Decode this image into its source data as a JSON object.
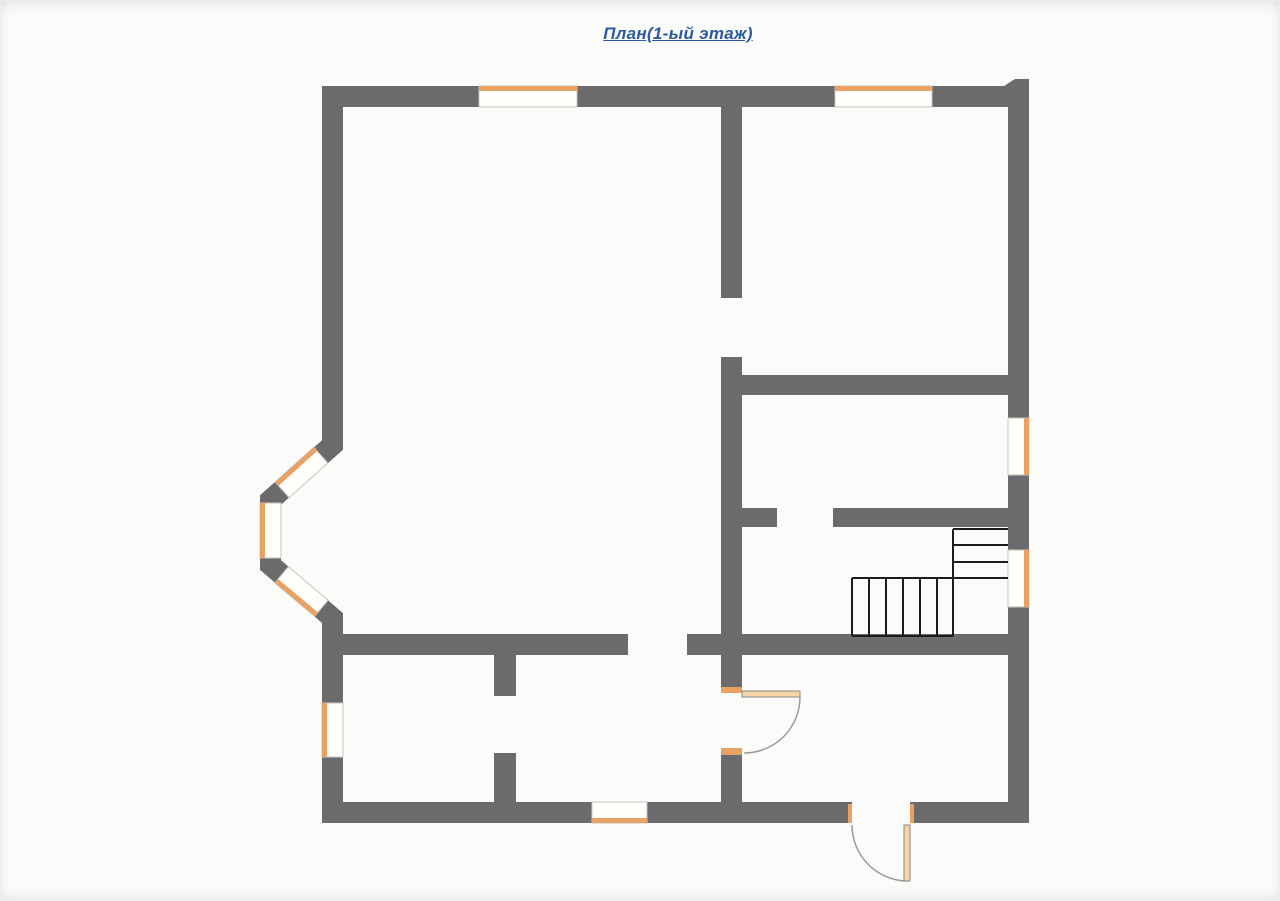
{
  "title": {
    "text": "План(1-ый этаж)"
  },
  "colors": {
    "background": "#fbfbf9",
    "wall": "#6b6a6d",
    "window_fill": "#fffefa",
    "window_frame": "#c6c5c0",
    "window_accent": "#e9a263",
    "stair_line": "#1c1c1c",
    "door_arc": "#9b9b9b",
    "door_leaf_fill": "#f6d4a4",
    "door_leaf_edge": "#8a8a8a",
    "title_color": "#2b5a9e"
  },
  "floorplan": {
    "canvas": {
      "width": 1280,
      "height": 901
    },
    "wall_rects": [
      {
        "name": "outer-wall-top-left",
        "x": 322,
        "y": 86,
        "w": 157,
        "h": 21
      },
      {
        "name": "outer-wall-top-mid",
        "x": 577,
        "y": 86,
        "w": 258,
        "h": 21
      },
      {
        "name": "outer-wall-top-right",
        "x": 932,
        "y": 86,
        "w": 72,
        "h": 21
      },
      {
        "name": "outer-wall-right-upper",
        "x": 1008,
        "y": 107,
        "w": 21,
        "h": 311
      },
      {
        "name": "outer-wall-right-mid",
        "x": 1008,
        "y": 475,
        "w": 21,
        "h": 75
      },
      {
        "name": "outer-wall-right-lower",
        "x": 1008,
        "y": 607,
        "w": 21,
        "h": 216
      },
      {
        "name": "outer-wall-bottom-left",
        "x": 322,
        "y": 802,
        "w": 270,
        "h": 21
      },
      {
        "name": "outer-wall-bottom-mid",
        "x": 647,
        "y": 802,
        "w": 205,
        "h": 21
      },
      {
        "name": "outer-wall-bottom-right",
        "x": 910,
        "y": 802,
        "w": 119,
        "h": 21
      },
      {
        "name": "outer-wall-left-upper",
        "x": 322,
        "y": 86,
        "w": 21,
        "h": 344
      },
      {
        "name": "outer-wall-left-lower-a",
        "x": 322,
        "y": 618,
        "w": 21,
        "h": 85
      },
      {
        "name": "outer-wall-left-lower-b",
        "x": 322,
        "y": 757,
        "w": 21,
        "h": 66
      },
      {
        "name": "interior-wall-center-upper",
        "x": 721,
        "y": 107,
        "w": 21,
        "h": 191
      },
      {
        "name": "interior-wall-center-mid",
        "x": 721,
        "y": 357,
        "w": 21,
        "h": 335
      },
      {
        "name": "interior-wall-center-lower",
        "x": 721,
        "y": 750,
        "w": 21,
        "h": 52
      },
      {
        "name": "interior-wall-room-right-bottom",
        "x": 742,
        "y": 375,
        "w": 266,
        "h": 20
      },
      {
        "name": "interior-wall-stair-top-stub",
        "x": 742,
        "y": 508,
        "w": 35,
        "h": 19
      },
      {
        "name": "interior-wall-stair-top",
        "x": 833,
        "y": 508,
        "w": 175,
        "h": 19
      },
      {
        "name": "interior-wall-left-room-bottom",
        "x": 343,
        "y": 634,
        "w": 285,
        "h": 21
      },
      {
        "name": "interior-wall-hall-stub",
        "x": 687,
        "y": 634,
        "w": 34,
        "h": 21
      },
      {
        "name": "interior-wall-stair-bottom",
        "x": 742,
        "y": 634,
        "w": 266,
        "h": 21
      },
      {
        "name": "interior-wall-divider-upper",
        "x": 494,
        "y": 655,
        "w": 22,
        "h": 41
      },
      {
        "name": "interior-wall-divider-lower",
        "x": 494,
        "y": 753,
        "w": 22,
        "h": 49
      }
    ],
    "wall_polys": [
      {
        "name": "outer-wall-top-right-corner-notch",
        "points": "1004,86 1015,79 1029,79 1029,107 1004,107"
      }
    ],
    "bay": {
      "name": "bay-window-wall",
      "path": "M 332.5,420 L 332.5,445 L 270.5,500 L 270.5,565 L 332.5,618 L 332.5,628",
      "stroke_width": 21
    },
    "windows": [
      {
        "name": "window-top-1",
        "x": 479,
        "y": 86,
        "w": 98,
        "h": 21,
        "accent": "top"
      },
      {
        "name": "window-top-2",
        "x": 835,
        "y": 86,
        "w": 97,
        "h": 21,
        "accent": "top"
      },
      {
        "name": "window-right-1",
        "x": 1008,
        "y": 418,
        "w": 21,
        "h": 57,
        "accent": "right"
      },
      {
        "name": "window-right-2",
        "x": 1008,
        "y": 550,
        "w": 21,
        "h": 57,
        "accent": "right"
      },
      {
        "name": "window-left-1",
        "x": 322,
        "y": 703,
        "w": 21,
        "h": 54,
        "accent": "left"
      },
      {
        "name": "window-bottom-1",
        "x": 592,
        "y": 802,
        "w": 55,
        "h": 21,
        "accent": "bottom"
      },
      {
        "name": "bay-window-middle",
        "x": 260,
        "y": 503,
        "w": 21,
        "h": 55,
        "accent": "left"
      }
    ],
    "bay_windows": [
      {
        "name": "bay-window-upper",
        "cx": 301.5,
        "cy": 472.5,
        "length": 52,
        "thickness": 21,
        "rotate": 138
      },
      {
        "name": "bay-window-lower",
        "cx": 301.5,
        "cy": 591.5,
        "length": 52,
        "thickness": 21,
        "rotate": 40
      }
    ],
    "doors": [
      {
        "name": "interior-door-hall",
        "leaf": {
          "x": 742,
          "y": 691,
          "w": 58,
          "h": 6
        },
        "arc": "M 800,697 A 56,56 0 0 1 744,753",
        "jambs": [
          {
            "x": 721,
            "y": 687,
            "w": 21,
            "h": 6
          },
          {
            "x": 721,
            "y": 748,
            "w": 21,
            "h": 7
          }
        ]
      },
      {
        "name": "entrance-door",
        "leaf": {
          "x": 904,
          "y": 825,
          "w": 6,
          "h": 56
        },
        "arc": "M 852,825 A 56,56 0 0 0 908,881",
        "jambs": [
          {
            "x": 848,
            "y": 804,
            "w": 4,
            "h": 19
          },
          {
            "x": 910,
            "y": 804,
            "w": 4,
            "h": 19
          }
        ]
      }
    ],
    "stairs": {
      "name": "staircase",
      "lines": [
        {
          "x1": 953,
          "y1": 529,
          "x2": 953,
          "y2": 636
        },
        {
          "x1": 953,
          "y1": 529,
          "x2": 1008,
          "y2": 529
        },
        {
          "x1": 953,
          "y1": 545,
          "x2": 1008,
          "y2": 545
        },
        {
          "x1": 953,
          "y1": 562,
          "x2": 1008,
          "y2": 562
        },
        {
          "x1": 852,
          "y1": 578,
          "x2": 1008,
          "y2": 578
        },
        {
          "x1": 852,
          "y1": 636,
          "x2": 953,
          "y2": 636
        },
        {
          "x1": 852,
          "y1": 578,
          "x2": 852,
          "y2": 636
        },
        {
          "x1": 869,
          "y1": 578,
          "x2": 869,
          "y2": 636
        },
        {
          "x1": 886,
          "y1": 578,
          "x2": 886,
          "y2": 636
        },
        {
          "x1": 903,
          "y1": 578,
          "x2": 903,
          "y2": 636
        },
        {
          "x1": 920,
          "y1": 578,
          "x2": 920,
          "y2": 636
        },
        {
          "x1": 937,
          "y1": 578,
          "x2": 937,
          "y2": 636
        }
      ]
    }
  }
}
